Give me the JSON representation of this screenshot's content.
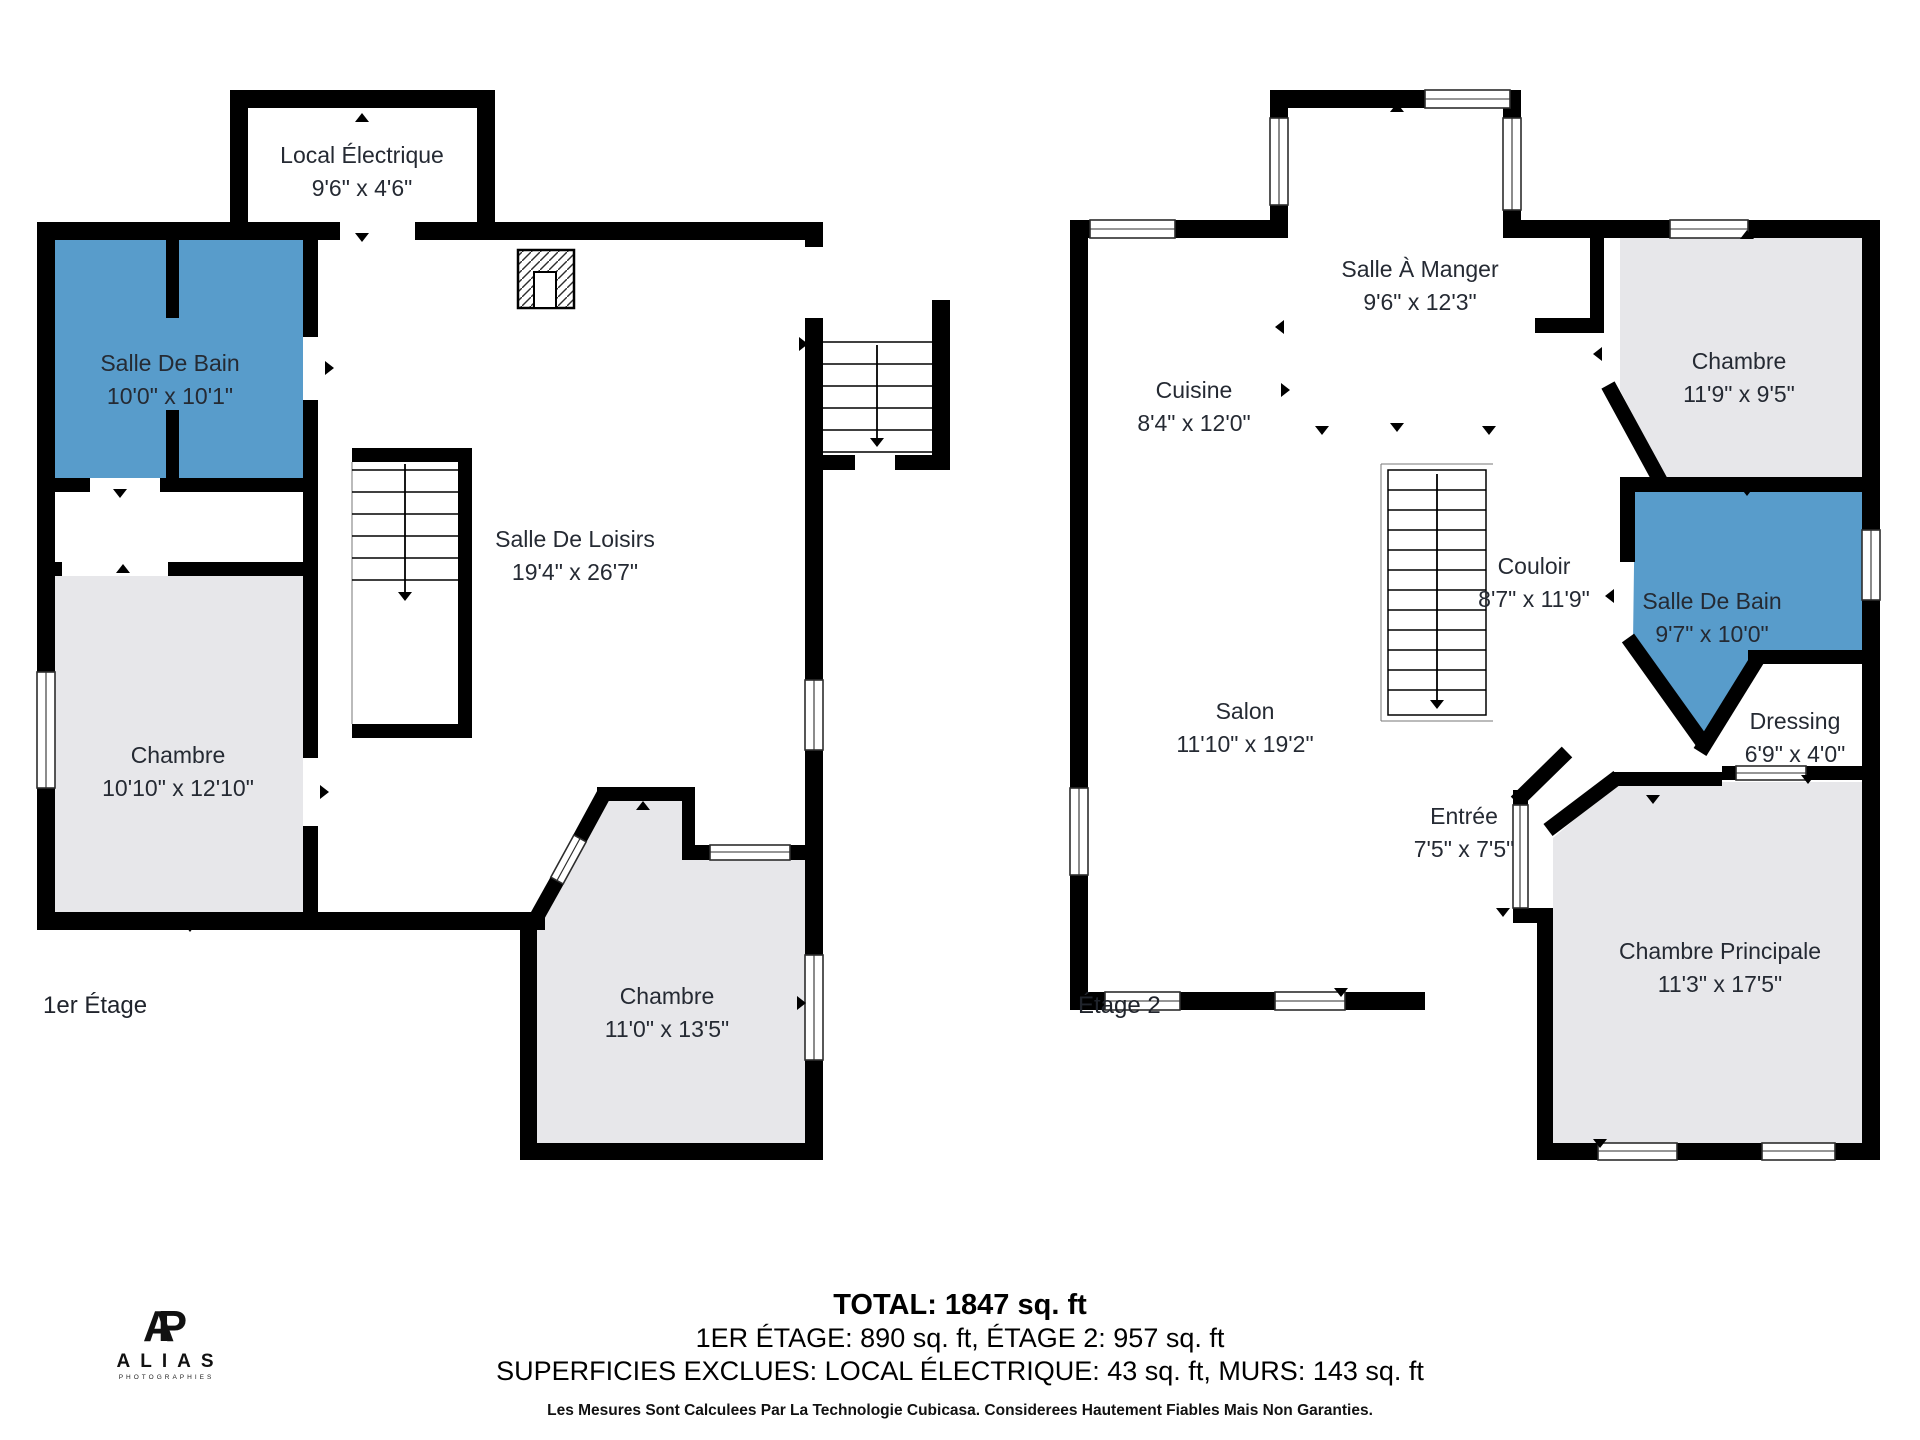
{
  "document_type": "floor-plan",
  "colors": {
    "wall": "#000000",
    "highlight_room": "#589CCB",
    "room_fill": "#E7E7EA",
    "text": "#252A33"
  },
  "floors": [
    {
      "label": "1er Étage",
      "rooms": [
        {
          "name": "Local Électrique",
          "dims": "9'6\" x 4'6\"",
          "highlight": false
        },
        {
          "name": "Salle De Bain",
          "dims": "10'0\" x 10'1\"",
          "highlight": true
        },
        {
          "name": "Salle De Loisirs",
          "dims": "19'4\" x 26'7\"",
          "highlight": false
        },
        {
          "name": "Chambre",
          "dims": "10'10\" x 12'10\"",
          "highlight": false
        },
        {
          "name": "Chambre",
          "dims": "11'0\" x 13'5\"",
          "highlight": false
        }
      ]
    },
    {
      "label": "Étage 2",
      "rooms": [
        {
          "name": "Salle À Manger",
          "dims": "9'6\" x 12'3\"",
          "highlight": false
        },
        {
          "name": "Cuisine",
          "dims": "8'4\" x 12'0\"",
          "highlight": false
        },
        {
          "name": "Chambre",
          "dims": "11'9\" x 9'5\"",
          "highlight": false
        },
        {
          "name": "Couloir",
          "dims": "8'7\" x 11'9\"",
          "highlight": false
        },
        {
          "name": "Salle De Bain",
          "dims": "9'7\" x 10'0\"",
          "highlight": true
        },
        {
          "name": "Dressing",
          "dims": "6'9\" x 4'0\"",
          "highlight": false
        },
        {
          "name": "Salon",
          "dims": "11'10\" x 19'2\"",
          "highlight": false
        },
        {
          "name": "Entrée",
          "dims": "7'5\" x 7'5\"",
          "highlight": false
        },
        {
          "name": "Chambre Principale",
          "dims": "11'3\" x 17'5\"",
          "highlight": false
        }
      ]
    }
  ],
  "summary": {
    "total": "TOTAL: 1847 sq. ft",
    "floors_line": "1ER ÉTAGE: 890 sq. ft, ÉTAGE 2: 957 sq. ft",
    "exclusions_line": "SUPERFICIES EXCLUES: LOCAL ÉLECTRIQUE: 43 sq. ft, MURS: 143 sq. ft",
    "disclaimer": "Les Mesures Sont Calculees Par La Technologie Cubicasa. Considerees Hautement Fiables Mais Non Garanties."
  },
  "branding": {
    "monogram_a": "A",
    "monogram_p": "P",
    "name": "ALIAS",
    "tagline": "PHOTOGRAPHIES"
  }
}
